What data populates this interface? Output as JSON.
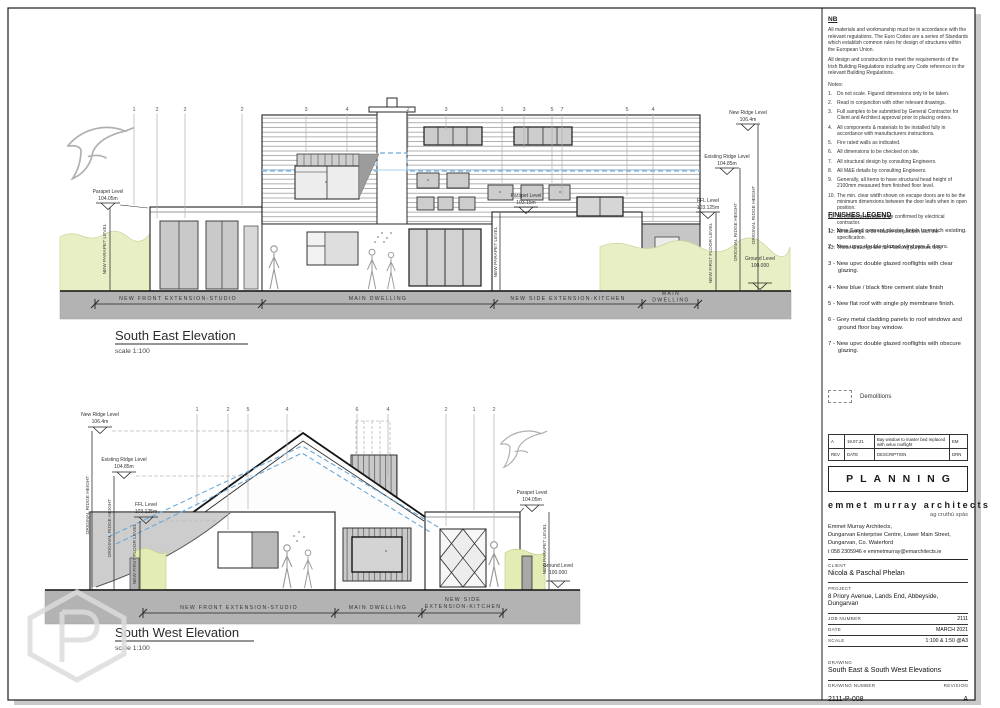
{
  "sheet": {
    "stamp": "PLANNING",
    "copyright": "© THIS DRAWING IS COPYRIGHT"
  },
  "notes": {
    "title": "NB",
    "para1": "All materials and workmanship must be in accordance with the relevant regulations. The Euro Codes are a series of Standards which establish common rules for design of structures within the European Union.",
    "para2": "All design and construction to meet the requirements of the Irish Building Regulations including any Code reference in the relevant Building Regulations.",
    "list_title": "Notes:",
    "items": [
      {
        "n": "1.",
        "t": "Do not scale. Figured dimensions only to be taken."
      },
      {
        "n": "2.",
        "t": "Read in conjunction with other relevant drawings."
      },
      {
        "n": "3.",
        "t": "Full samples to be submitted by General Contractor for Client and Architect approval prior to placing orders."
      },
      {
        "n": "4.",
        "t": "All components & materials to be installed fully in accordance with manufacturers instructions."
      },
      {
        "n": "5.",
        "t": "Fire rated walls as indicated."
      },
      {
        "n": "6.",
        "t": "All dimensions to be checked on site."
      },
      {
        "n": "7.",
        "t": "All structural design by consulting Engineers."
      },
      {
        "n": "8.",
        "t": "All M&E details by consulting Engineers."
      },
      {
        "n": "9.",
        "t": "Generally, all items to have structural head height of 2100mm measured from finished floor level."
      },
      {
        "n": "10.",
        "t": "The min. clear width shown on escape doors are to be the minimum dimensions between the door leafs when in open position."
      },
      {
        "n": "11.",
        "t": "All electrical layouts to be confirmed by electrical contractor."
      },
      {
        "n": "12.",
        "t": "All drawings to be read in conjunction with the specification."
      },
      {
        "n": "13.",
        "t": "These drawings are for Planning purposes only."
      }
    ]
  },
  "finishes": {
    "title": "FINISHES LEGEND",
    "items": [
      "1 - New Sand cement plaster finish to match existing.",
      "2 - New upvc double glazed windows & doors.",
      "3 - New upvc double glazed rooflights with clear glazing.",
      "4 - New blue / black fibre cement slate finish",
      "5 - New flat roof with single ply membrane finish.",
      "6 - Grey metal cladding panels to roof windows and ground floor bay window.",
      "7 - New upvc double glazed rooflights with obscure glazing."
    ],
    "demolitions": "Demolitions"
  },
  "revisions": {
    "rev": "A",
    "date": "19.07.21",
    "desc": "Bay window to master bed replaced with velux rooflight",
    "drn": "EM",
    "h_rev": "REV",
    "h_date": "DATE",
    "h_desc": "DESCRIPTION",
    "h_drn": "DRN"
  },
  "firm": {
    "name": "emmet murray architects",
    "tagline": "ag cruthú spás",
    "addr1": "Emmet Murray Architects,",
    "addr2": "Dungarvan Enterprise Centre, Lower Main Street,",
    "addr3": "Dungarvan, Co. Waterford",
    "contact": "t  058 2305946     e  emmetmurray@emarchitects.ie"
  },
  "titleblock": {
    "client_label": "CLIENT",
    "client": "Nicola & Paschal Phelan",
    "project_label": "PROJECT",
    "project": "8 Priory Avenue, Lands End, Abbeyside, Dungarvan",
    "job_label": "JOB NUMBER",
    "job": "2111",
    "date_label": "DATE",
    "date": "MARCH 2021",
    "scale_label": "SCALE",
    "scale": "1:100 & 1:50 @A3",
    "drawing_label": "DRAWING",
    "drawing": "South East & South West Elevations",
    "number_label": "DRAWING NUMBER",
    "number": "2111-P-008",
    "revision_label": "REVISION",
    "revision": "A"
  },
  "levels": {
    "new_ridge_l": "New Ridge Level",
    "new_ridge_v": "106.4m",
    "exist_ridge_l": "Existing Ridge Level",
    "exist_ridge_v": "104.85m",
    "parapet_l": "Parapet Level",
    "parapet_main_v": "104.05m",
    "parapet_kitchen_v": "103.15m",
    "ffl_l": "FFL Level",
    "ffl_v": "103.125m",
    "ground_l": "Ground Level",
    "ground_v": "100.000",
    "new_parapet": "NEW PARAPET LEVEL",
    "orig_ridge": "ORIGINAL RIDGE HEIGHT",
    "new_ffl": "NEW FIRST FLOOR LEVEL"
  },
  "dims": {
    "studio": "NEW FRONT EXTENSION-STUDIO",
    "main": "MAIN DWELLING",
    "kitchen": "NEW SIDE EXTENSION-KITCHEN",
    "main_1": "MAIN",
    "main_2": "DWELLING",
    "kitchen_1": "NEW SIDE",
    "kitchen_2": "EXTENSION-KITCHEN"
  },
  "se": {
    "title": "South East Elevation",
    "scale": "scale 1:100",
    "keynotes": [
      "1",
      "2",
      "2",
      "2",
      "3",
      "4",
      "2",
      "3",
      "1",
      "3",
      "5",
      "7",
      "5",
      "4"
    ]
  },
  "sw": {
    "title": "South West Elevation",
    "scale": "scale 1:100",
    "keynotes": [
      "1",
      "2",
      "5",
      "4",
      "6",
      "4",
      "2",
      "1",
      "2"
    ]
  }
}
